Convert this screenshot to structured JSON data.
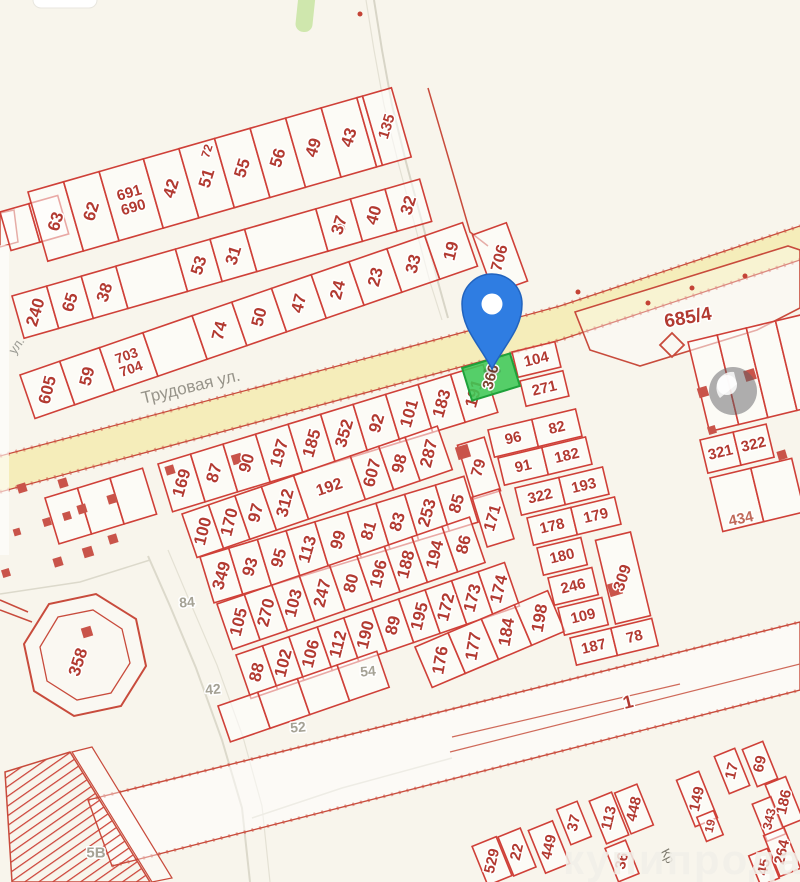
{
  "map": {
    "bg": "#f8f5ec",
    "style": {
      "plot_fill": "rgba(255,255,255,0.55)",
      "plot_stroke": "#cf4038",
      "label_color": "#b23a31",
      "halo": "#ffffff",
      "road_fill": "#f5edba",
      "building_color": "#c9544a",
      "pin_fill": "#2f7de2",
      "pin_stroke": "#2163be",
      "pin_hole": "#ffffff"
    },
    "street_labels": {
      "trudovaya": "Трудовая ул.",
      "ul": "ул.",
      "kr": "Кр"
    },
    "watermark": "купипродай",
    "selected": {
      "t": "366",
      "x": 491,
      "y": 377,
      "w": 50,
      "h": 34,
      "r": -17,
      "lr": -74,
      "fill": "rgba(62,200,85,0.88)",
      "stroke": "#1fa13a",
      "label_color": "#7d4531"
    },
    "rows": [
      {
        "x": 0,
        "y": 212,
        "a": -16,
        "d": 40,
        "w": 30,
        "cells": [
          {},
          {}
        ]
      },
      {
        "x": 28,
        "y": 192,
        "a": -16,
        "d": 72,
        "w": 37,
        "cells": [
          {
            "t": "63"
          },
          {
            "t": "62"
          },
          {
            "t": "691\n690",
            "w": 46,
            "h": 1,
            "fs": 15
          },
          {
            "t": "42"
          },
          {
            "t": "51"
          },
          {
            "t": "55"
          },
          {
            "t": "56"
          },
          {
            "t": "49"
          },
          {
            "t": "43"
          },
          {
            "w": 6
          },
          {
            "t": "135",
            "w": 30,
            "fs": 15
          }
        ]
      },
      {
        "x": 12,
        "y": 296,
        "a": -16,
        "d": 44,
        "w": 36,
        "cells": [
          {
            "t": "240"
          },
          {
            "t": "65"
          },
          {
            "t": "38"
          },
          {
            "w": 62
          },
          {
            "t": "53"
          },
          {
            "t": "31"
          },
          {
            "w": 74
          },
          {
            "t": "37"
          },
          {
            "t": "40"
          },
          {
            "t": "32"
          }
        ]
      },
      {
        "x": 20,
        "y": 375,
        "a": -19,
        "d": 46,
        "w": 42,
        "cells": [
          {
            "t": "605"
          },
          {
            "t": "59"
          },
          {
            "t": "703\n704",
            "w": 46,
            "h": 1,
            "fs": 14
          },
          {
            "w": 52
          },
          {
            "t": "74"
          },
          {
            "t": "50"
          },
          {
            "t": "47"
          },
          {
            "t": "24",
            "w": 40
          },
          {
            "t": "23",
            "w": 40
          },
          {
            "t": "33",
            "w": 40
          },
          {
            "t": "19",
            "w": 40
          }
        ]
      },
      {
        "x": 45,
        "y": 498,
        "a": -17,
        "d": 48,
        "w": 34,
        "cells": [
          {},
          {},
          {}
        ]
      },
      {
        "x": 158,
        "y": 464,
        "a": -17,
        "d": 50,
        "w": 34,
        "cells": [
          {
            "t": "169"
          },
          {
            "t": "87"
          },
          {
            "t": "90"
          },
          {
            "t": "197"
          },
          {
            "t": "185"
          },
          {
            "t": "352"
          },
          {
            "t": "92"
          },
          {
            "t": "101"
          },
          {
            "t": "183"
          },
          {
            "t": "191"
          }
        ]
      },
      {
        "x": 182,
        "y": 514,
        "a": -19,
        "d": 46,
        "w": 28,
        "cells": [
          {
            "t": "100"
          },
          {
            "t": "170"
          },
          {
            "t": "97"
          },
          {
            "t": "312",
            "w": 34
          },
          {
            "t": "192",
            "w": 60,
            "h": 1,
            "fs": 16
          },
          {
            "t": "607",
            "w": 30
          },
          {
            "t": "98"
          },
          {
            "t": "287",
            "w": 34
          }
        ]
      },
      {
        "x": 200,
        "y": 557,
        "a": -17,
        "d": 48,
        "w": 30,
        "cells": [
          {
            "t": "349"
          },
          {
            "t": "93"
          },
          {
            "t": "95"
          },
          {
            "t": "113"
          },
          {
            "t": "99",
            "w": 34
          },
          {
            "t": "81"
          },
          {
            "t": "83"
          },
          {
            "t": "253",
            "w": 32
          },
          {
            "t": "85"
          }
        ]
      },
      {
        "x": 217,
        "y": 604,
        "a": -19,
        "d": 48,
        "w": 29,
        "cells": [
          {
            "t": "105"
          },
          {
            "t": "270"
          },
          {
            "t": "103"
          },
          {
            "t": "247",
            "w": 32
          },
          {
            "t": "80"
          },
          {
            "t": "196"
          },
          {
            "t": "188"
          },
          {
            "t": "194",
            "w": 32
          },
          {
            "t": "86"
          }
        ]
      },
      {
        "x": 236,
        "y": 655,
        "a": -19,
        "d": 46,
        "w": 28,
        "cells": [
          {
            "t": "88"
          },
          {
            "t": "102"
          },
          {
            "t": "106",
            "w": 30
          },
          {
            "t": "112"
          },
          {
            "t": "190",
            "w": 30
          },
          {
            "t": "89"
          },
          {
            "t": "195"
          },
          {
            "t": "172"
          },
          {
            "t": "173"
          },
          {
            "t": "174"
          }
        ]
      },
      {
        "x": 415,
        "y": 647,
        "a": -23,
        "d": 44,
        "w": 36,
        "cells": [
          {
            "t": "176"
          },
          {
            "t": "177"
          },
          {
            "t": "184"
          },
          {
            "t": "198"
          }
        ]
      },
      {
        "x": 218,
        "y": 706,
        "a": -19,
        "d": 38,
        "w": 42,
        "cells": [
          {},
          {},
          {},
          {}
        ]
      },
      {
        "x": 512,
        "y": 352,
        "a": -13.5,
        "d": 26,
        "w": 44,
        "cells": [
          {
            "t": "104",
            "h": 1,
            "fs": 15
          }
        ]
      },
      {
        "x": 520,
        "y": 381,
        "a": -13.5,
        "d": 26,
        "w": 44,
        "cells": [
          {
            "t": "271",
            "h": 1,
            "fs": 15
          }
        ]
      },
      {
        "x": 488,
        "y": 430,
        "a": -13.5,
        "d": 28,
        "w": 45,
        "cells": [
          {
            "t": "96",
            "h": 1,
            "fs": 15
          },
          {
            "t": "82",
            "h": 1,
            "fs": 15
          }
        ]
      },
      {
        "x": 498,
        "y": 458,
        "a": -13.5,
        "d": 28,
        "w": 45,
        "cells": [
          {
            "t": "91",
            "h": 1,
            "fs": 15
          },
          {
            "t": "182",
            "h": 1,
            "fs": 15
          }
        ]
      },
      {
        "x": 515,
        "y": 488,
        "a": -13.5,
        "d": 28,
        "w": 45,
        "cells": [
          {
            "t": "322",
            "h": 1,
            "fs": 15
          },
          {
            "t": "193",
            "h": 1,
            "fs": 15
          }
        ]
      },
      {
        "x": 527,
        "y": 518,
        "a": -13.5,
        "d": 28,
        "w": 45,
        "cells": [
          {
            "t": "178",
            "h": 1,
            "fs": 15
          },
          {
            "t": "179",
            "h": 1,
            "fs": 15
          }
        ]
      },
      {
        "x": 537,
        "y": 548,
        "a": -13.5,
        "d": 28,
        "w": 45,
        "cells": [
          {
            "t": "180",
            "h": 1,
            "fs": 15
          }
        ]
      },
      {
        "x": 548,
        "y": 578,
        "a": -13.5,
        "d": 28,
        "w": 45,
        "cells": [
          {
            "t": "246",
            "h": 1,
            "fs": 15
          }
        ]
      },
      {
        "x": 558,
        "y": 608,
        "a": -13.5,
        "d": 28,
        "w": 45,
        "cells": [
          {
            "t": "109",
            "h": 1,
            "fs": 15
          }
        ]
      },
      {
        "x": 570,
        "y": 638,
        "a": -13.5,
        "d": 28,
        "w": 42,
        "cells": [
          {
            "t": "187",
            "h": 1,
            "fs": 15
          },
          {
            "t": "78",
            "h": 1,
            "fs": 15
          }
        ]
      },
      {
        "x": 688,
        "y": 342,
        "a": -13.5,
        "d": 92,
        "w": 30,
        "cells": [
          {},
          {},
          {},
          {}
        ]
      },
      {
        "x": 700,
        "y": 440,
        "a": -13.5,
        "d": 34,
        "w": 34,
        "cells": [
          {
            "t": "321",
            "h": 1,
            "fs": 15
          },
          {
            "t": "322",
            "h": 1,
            "fs": 15
          }
        ]
      },
      {
        "x": 710,
        "y": 478,
        "a": -13.5,
        "d": 55,
        "w": 42,
        "cells": [
          {},
          {}
        ]
      }
    ],
    "cells": [
      {
        "t": "79",
        "x": 479,
        "y": 468,
        "w": 28,
        "h": 56,
        "r": -17,
        "lr": -74,
        "fs": 16
      },
      {
        "t": "171",
        "x": 493,
        "y": 518,
        "w": 28,
        "h": 52,
        "r": -17,
        "lr": -74,
        "fs": 16
      },
      {
        "t": "309",
        "x": 623,
        "y": 578,
        "w": 36,
        "h": 86,
        "r": -13.5,
        "lr": -72,
        "fs": 16
      },
      {
        "t": "706",
        "x": 500,
        "y": 258,
        "w": 36,
        "h": 62,
        "r": -20,
        "lr": -75,
        "fs": 16
      },
      {
        "t": "529",
        "x": 492,
        "y": 861,
        "w": 26,
        "h": 42
      },
      {
        "t": "22",
        "x": 517,
        "y": 852,
        "w": 24,
        "h": 42
      },
      {
        "t": "449",
        "x": 549,
        "y": 847,
        "w": 26,
        "h": 46
      },
      {
        "t": "37",
        "x": 574,
        "y": 823,
        "w": 22,
        "h": 38
      },
      {
        "t": "113",
        "x": 609,
        "y": 818,
        "w": 24,
        "h": 46
      },
      {
        "t": "448",
        "x": 634,
        "y": 809,
        "w": 24,
        "h": 44
      },
      {
        "t": "36",
        "x": 622,
        "y": 861,
        "w": 22,
        "h": 36
      },
      {
        "t": "149",
        "x": 697,
        "y": 799,
        "w": 24,
        "h": 50
      },
      {
        "t": "19",
        "x": 710,
        "y": 826,
        "w": 18,
        "h": 26,
        "fs": 12
      },
      {
        "t": "17",
        "x": 732,
        "y": 771,
        "w": 22,
        "h": 40
      },
      {
        "t": "69",
        "x": 760,
        "y": 764,
        "w": 22,
        "h": 40
      },
      {
        "t": "186",
        "x": 784,
        "y": 802,
        "w": 22,
        "h": 46
      },
      {
        "t": "343",
        "x": 769,
        "y": 819,
        "w": 20,
        "h": 40,
        "fs": 13
      },
      {
        "t": "264",
        "x": 782,
        "y": 852,
        "w": 22,
        "h": 44
      },
      {
        "t": "45",
        "x": 764,
        "y": 867,
        "w": 20,
        "h": 32
      }
    ],
    "labels": [
      {
        "t": "72",
        "x": 207,
        "y": 151,
        "r": -72,
        "fs": 12,
        "c": "#b23a31"
      },
      {
        "t": "434",
        "x": 741,
        "y": 519,
        "r": -12,
        "fs": 15,
        "c": "#c06a5a"
      },
      {
        "t": "358",
        "x": 78,
        "y": 662,
        "r": -72,
        "fs": 17,
        "c": "#b23a31"
      },
      {
        "t": "1",
        "x": 628,
        "y": 702,
        "r": -14,
        "fs": 18,
        "c": "#b23a31"
      },
      {
        "t": "685/4",
        "x": 688,
        "y": 318,
        "r": -10,
        "fs": 19,
        "c": "#b23a31"
      },
      {
        "t": "84",
        "x": 187,
        "y": 602,
        "r": -5,
        "fs": 14,
        "c": "#a5a295"
      },
      {
        "t": "42",
        "x": 213,
        "y": 689,
        "r": -5,
        "fs": 14,
        "c": "#a5a295"
      },
      {
        "t": "52",
        "x": 298,
        "y": 727,
        "r": -5,
        "fs": 14,
        "c": "#a5a295"
      },
      {
        "t": "54",
        "x": 368,
        "y": 671,
        "r": -5,
        "fs": 14,
        "c": "#a5a295"
      },
      {
        "t": "5В",
        "x": 96,
        "y": 853,
        "r": 0,
        "fs": 15,
        "c": "#a5a295"
      }
    ],
    "squares": [
      [
        22,
        488,
        9
      ],
      [
        63,
        483,
        9
      ],
      [
        112,
        499,
        9
      ],
      [
        47,
        522,
        8
      ],
      [
        67,
        516,
        8
      ],
      [
        82,
        509,
        9
      ],
      [
        113,
        539,
        9
      ],
      [
        88,
        552,
        10
      ],
      [
        58,
        562,
        9
      ],
      [
        17,
        532,
        7
      ],
      [
        6,
        573,
        8
      ],
      [
        170,
        470,
        9
      ],
      [
        237,
        459,
        10
      ],
      [
        463,
        452,
        13
      ],
      [
        615,
        589,
        13
      ],
      [
        703,
        392,
        10
      ],
      [
        750,
        375,
        11
      ],
      [
        782,
        455,
        9
      ],
      [
        712,
        430,
        8
      ],
      [
        87,
        632,
        10
      ],
      [
        341,
        227,
        7
      ]
    ],
    "dots": [
      [
        360,
        14
      ],
      [
        578,
        292
      ],
      [
        648,
        303
      ],
      [
        692,
        288
      ],
      [
        745,
        276
      ]
    ],
    "shapes": [
      {
        "k": "pg",
        "p": "0,456 420,344 560,306 800,226 800,260 560,340 420,378 0,492",
        "f": "#f5edba"
      },
      {
        "k": "pl",
        "p": "0,456 420,344 560,306 800,226",
        "s": "#c84b3c",
        "w": 1.3
      },
      {
        "k": "pl",
        "p": "0,456 420,344 560,306 800,226",
        "s": "rgba(205,75,60,0.45)",
        "w": 4,
        "da": "2 6"
      },
      {
        "k": "pl",
        "p": "0,492 420,378 560,340 800,260",
        "s": "#c84b3c",
        "w": 1.3
      },
      {
        "k": "pl",
        "p": "0,492 420,378 560,340 800,260",
        "s": "rgba(205,75,60,0.45)",
        "w": 4,
        "da": "2 6"
      },
      {
        "k": "pl",
        "p": "374,0 382,50 392,105 406,162 422,222 438,282 448,318",
        "s": "#d8d5c7",
        "w": 2
      },
      {
        "k": "pl",
        "p": "366,0 374,50 384,105 398,162 414,222 430,282 442,320",
        "s": "#e4e1d4",
        "w": 1.2
      },
      {
        "k": "pl",
        "p": "148,556 170,606 196,668 222,740 242,808 250,882",
        "s": "#dcd9cb",
        "w": 2
      },
      {
        "k": "pl",
        "p": "168,550 190,602 217,665 243,737 262,806 270,882",
        "s": "#e4e1d4",
        "w": 1.2
      },
      {
        "k": "pl",
        "p": "150,560 80,582 0,594",
        "s": "#dcd9cb",
        "w": 1.5
      },
      {
        "k": "pl",
        "p": "252,818 342,788 452,758",
        "s": "#dcd9cb",
        "w": 1.5
      },
      {
        "k": "pg",
        "p": "88,800 800,622 800,690 112,866",
        "f": "rgba(255,255,255,0.5)",
        "s": "#c84b3c",
        "w": 1.4
      },
      {
        "k": "pl",
        "p": "88,800 800,622",
        "s": "rgba(205,75,60,0.5)",
        "w": 3.5,
        "da": "2 6"
      },
      {
        "k": "pl",
        "p": "112,866 800,690",
        "s": "rgba(205,75,60,0.5)",
        "w": 3.5,
        "da": "2 6"
      },
      {
        "k": "pl",
        "p": "450,752 800,664",
        "s": "#cf6a5a",
        "w": 1.2
      },
      {
        "k": "pl",
        "p": "452,737 680,684",
        "s": "#cf6a5a",
        "w": 1.2
      },
      {
        "k": "pg",
        "p": "575,312 788,246 800,250 800,308 757,330 640,366 590,350",
        "f": "rgba(255,255,255,0.35)",
        "s": "#c84b3c",
        "w": 1.6
      },
      {
        "k": "pg",
        "p": "672,333 684,345 672,357 660,345",
        "s": "#c84b3c",
        "w": 1.8
      },
      {
        "k": "pg",
        "p": "146,666 121,706 74,716 34,691 24,644 49,604 96,594 136,619",
        "f": "rgba(255,255,255,0.3)",
        "s": "#c84b3c",
        "w": 2
      },
      {
        "k": "pg",
        "p": "130,663 111,693 77,700 47,681 40,647 58,617 93,610 122,629",
        "s": "#c84b3c",
        "w": 1.3
      },
      {
        "k": "ln",
        "p": "28,612 0,600",
        "s": "#c84b3c",
        "w": 1.5
      },
      {
        "k": "ln",
        "p": "32,622 0,610",
        "s": "#c84b3c",
        "w": 1.5
      },
      {
        "k": "pg",
        "p": "5,772 70,752 150,882 12,882",
        "f": "url(#hatch)",
        "s": "#c84b3c",
        "w": 1.5
      },
      {
        "k": "pg",
        "p": "72,752 92,747 172,878 152,882",
        "f": "rgba(255,255,255,0.4)",
        "s": "#c84b3c",
        "w": 1.2
      },
      {
        "k": "pg",
        "p": "0,213 14,210 18,242 0,247",
        "f": "rgba(255,255,255,0.5)",
        "s": "#c84b3c",
        "w": 1.5
      },
      {
        "k": "pl",
        "p": "428,88 452,170 470,232 488,246",
        "s": "#c84b3c",
        "w": 1.5
      },
      {
        "k": "re",
        "p": "0,245 9,310",
        "f": "rgba(255,255,255,0.6)"
      }
    ]
  }
}
